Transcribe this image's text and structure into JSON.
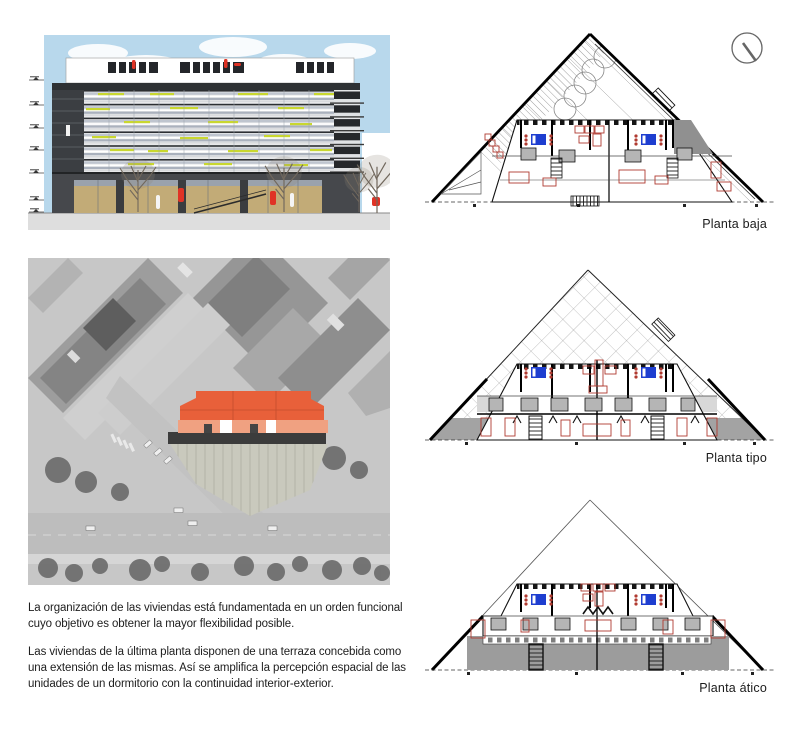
{
  "text": {
    "paragraph_1": "La organización de las viviendas está fundamentada en un orden funcional cuyo objetivo es obtener la mayor flexibilidad posible.",
    "paragraph_2": "Las viviendas de la última planta disponen de una terraza concebida como una extensión de las mismas. Así se amplifica la percepción espacial de las unidades de un dormitorio con la continuidad interior-exterior."
  },
  "plans": [
    {
      "label": "Planta baja"
    },
    {
      "label": "Planta tipo"
    },
    {
      "label": "Planta ático"
    }
  ],
  "colors": {
    "sky": "#b8d8ec",
    "accent_yellow": "#c9d72f",
    "ground_floor_tan": "#c2ab77",
    "people_red": "#e03325",
    "furniture_red": "#b03a30",
    "bed_blue": "#1e3ed0",
    "site_roof_orange": "#e8603a",
    "site_facade_orange": "#f0a181",
    "terrace_gray": "#9c9c9c"
  }
}
